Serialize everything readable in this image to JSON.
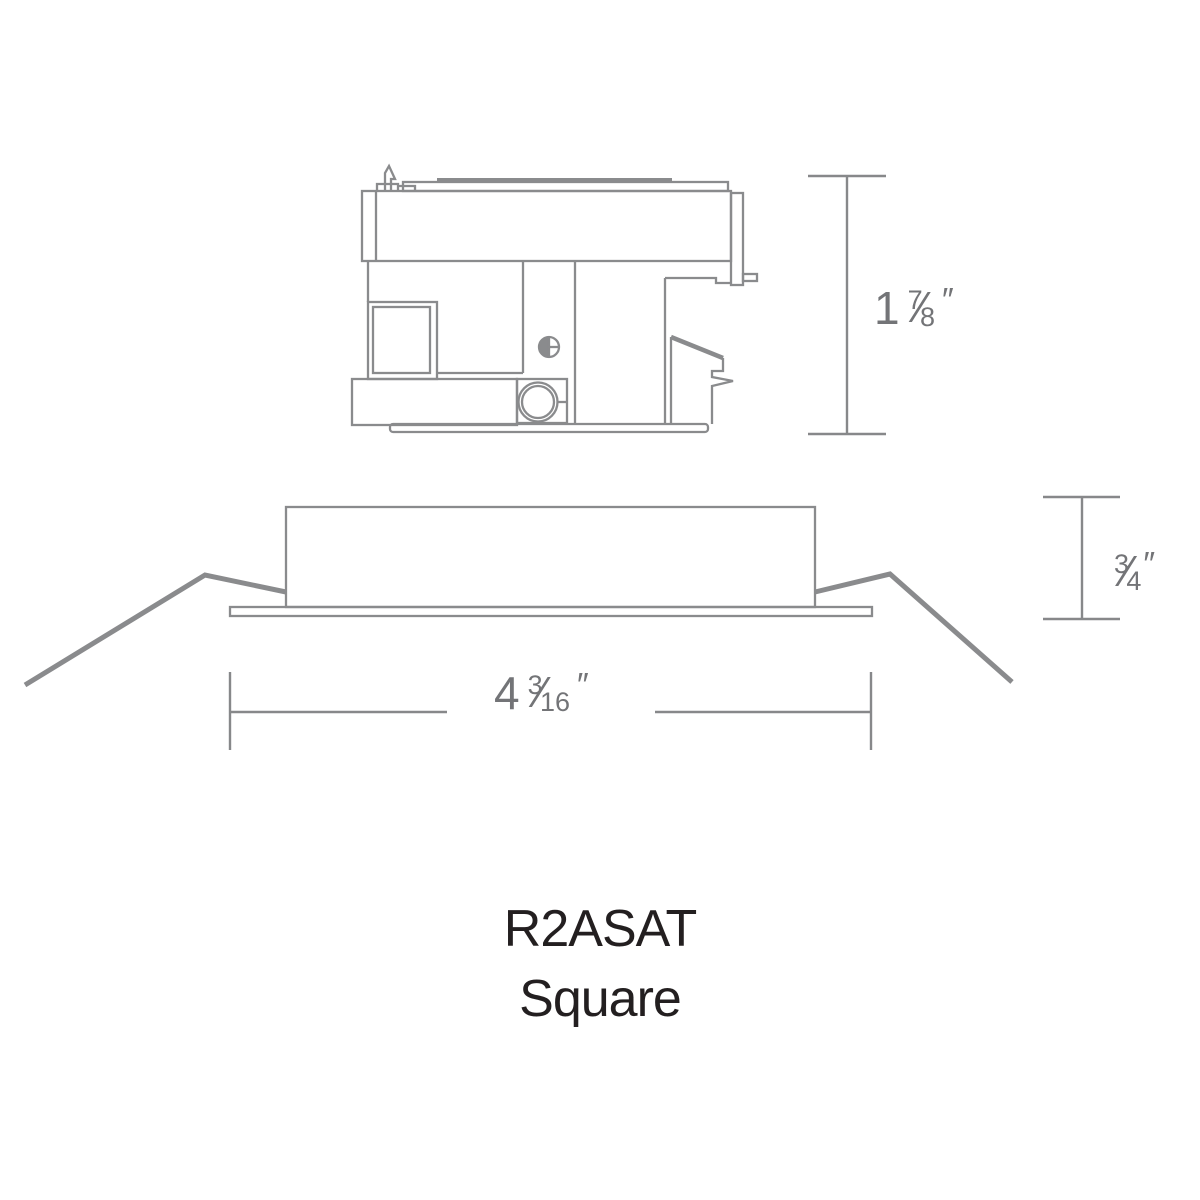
{
  "title": {
    "line1": "R2ASAT",
    "line2": "Square"
  },
  "colors": {
    "background": "#ffffff",
    "drawing_line": "#8a8b8d",
    "dimension": "#737477",
    "title_text": "#231f20"
  },
  "dimensions": {
    "housing_height": {
      "whole": "1",
      "numerator": "7",
      "slash": "⁄",
      "denominator": "8",
      "unit": "″"
    },
    "trim_depth": {
      "numerator": "3",
      "slash": "⁄",
      "denominator": "4",
      "unit": "″"
    },
    "aperture_width": {
      "whole": "4",
      "numerator": "3",
      "slash": "⁄",
      "denominator": "16",
      "unit": "″"
    }
  }
}
